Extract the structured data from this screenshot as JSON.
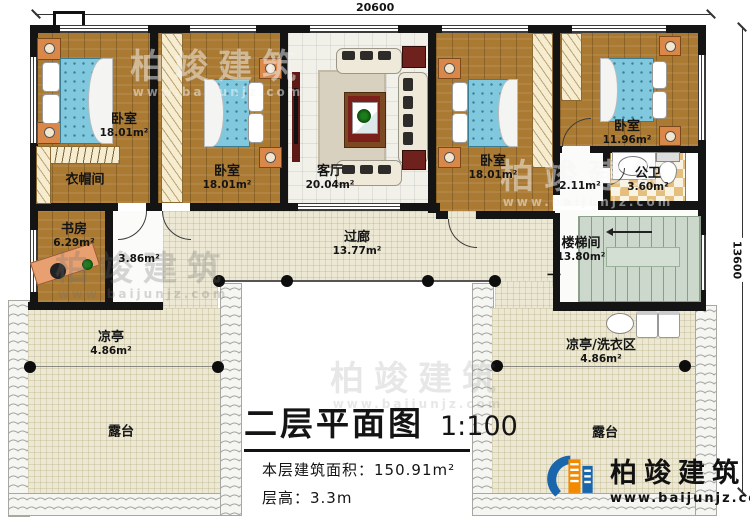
{
  "dimensions": {
    "top": "20600",
    "right": "13600"
  },
  "rooms": {
    "bedroom1": {
      "name": "卧室",
      "area": "18.01m²"
    },
    "bedroom2": {
      "name": "卧室",
      "area": "18.01m²"
    },
    "bedroom3": {
      "name": "卧室",
      "area": "18.01m²"
    },
    "bedroom4": {
      "name": "卧室",
      "area": "11.96m²"
    },
    "cloakroom": {
      "name": "衣帽间"
    },
    "study": {
      "name": "书房",
      "area": "6.29m²"
    },
    "open_area": {
      "area": "3.86m²"
    },
    "living": {
      "name": "客厅",
      "area": "20.04m²"
    },
    "corridor": {
      "name": "过廊",
      "area": "13.77m²"
    },
    "hallway": {
      "area": "2.11m²"
    },
    "bathroom": {
      "name": "公卫",
      "area": "3.60m²"
    },
    "stairwell": {
      "name": "楼梯间",
      "area": "13.80m²",
      "direction": "下"
    },
    "pavilion_left": {
      "name": "凉亭",
      "area": "4.86m²"
    },
    "laundry_pavilion": {
      "name": "凉亭/洗衣区",
      "area": "4.86m²"
    },
    "terrace_left": {
      "name": "露台"
    },
    "terrace_right": {
      "name": "露台"
    }
  },
  "title_block": {
    "title": "二层平面图",
    "scale": "1:100",
    "floor_area": "本层建筑面积：150.91m²",
    "floor_height": "层高：3.3m"
  },
  "branding": {
    "logo_text": "柏竣建筑",
    "website": "www.baijunjz.com"
  },
  "watermark": {
    "text": "柏竣建筑",
    "subtext": "www.baijunjz.com"
  },
  "colors": {
    "wall": "#141414",
    "wood_floor": "#aa7a33",
    "bed_blue": "#7fc8de",
    "terrace_beige": "#ece8d4",
    "bath_tile": "#e5bf7e",
    "stair_green": "#ccd8cb",
    "accent_red": "#6e211d",
    "logo_blue": "#1a66ad",
    "logo_orange": "#f28a00"
  }
}
